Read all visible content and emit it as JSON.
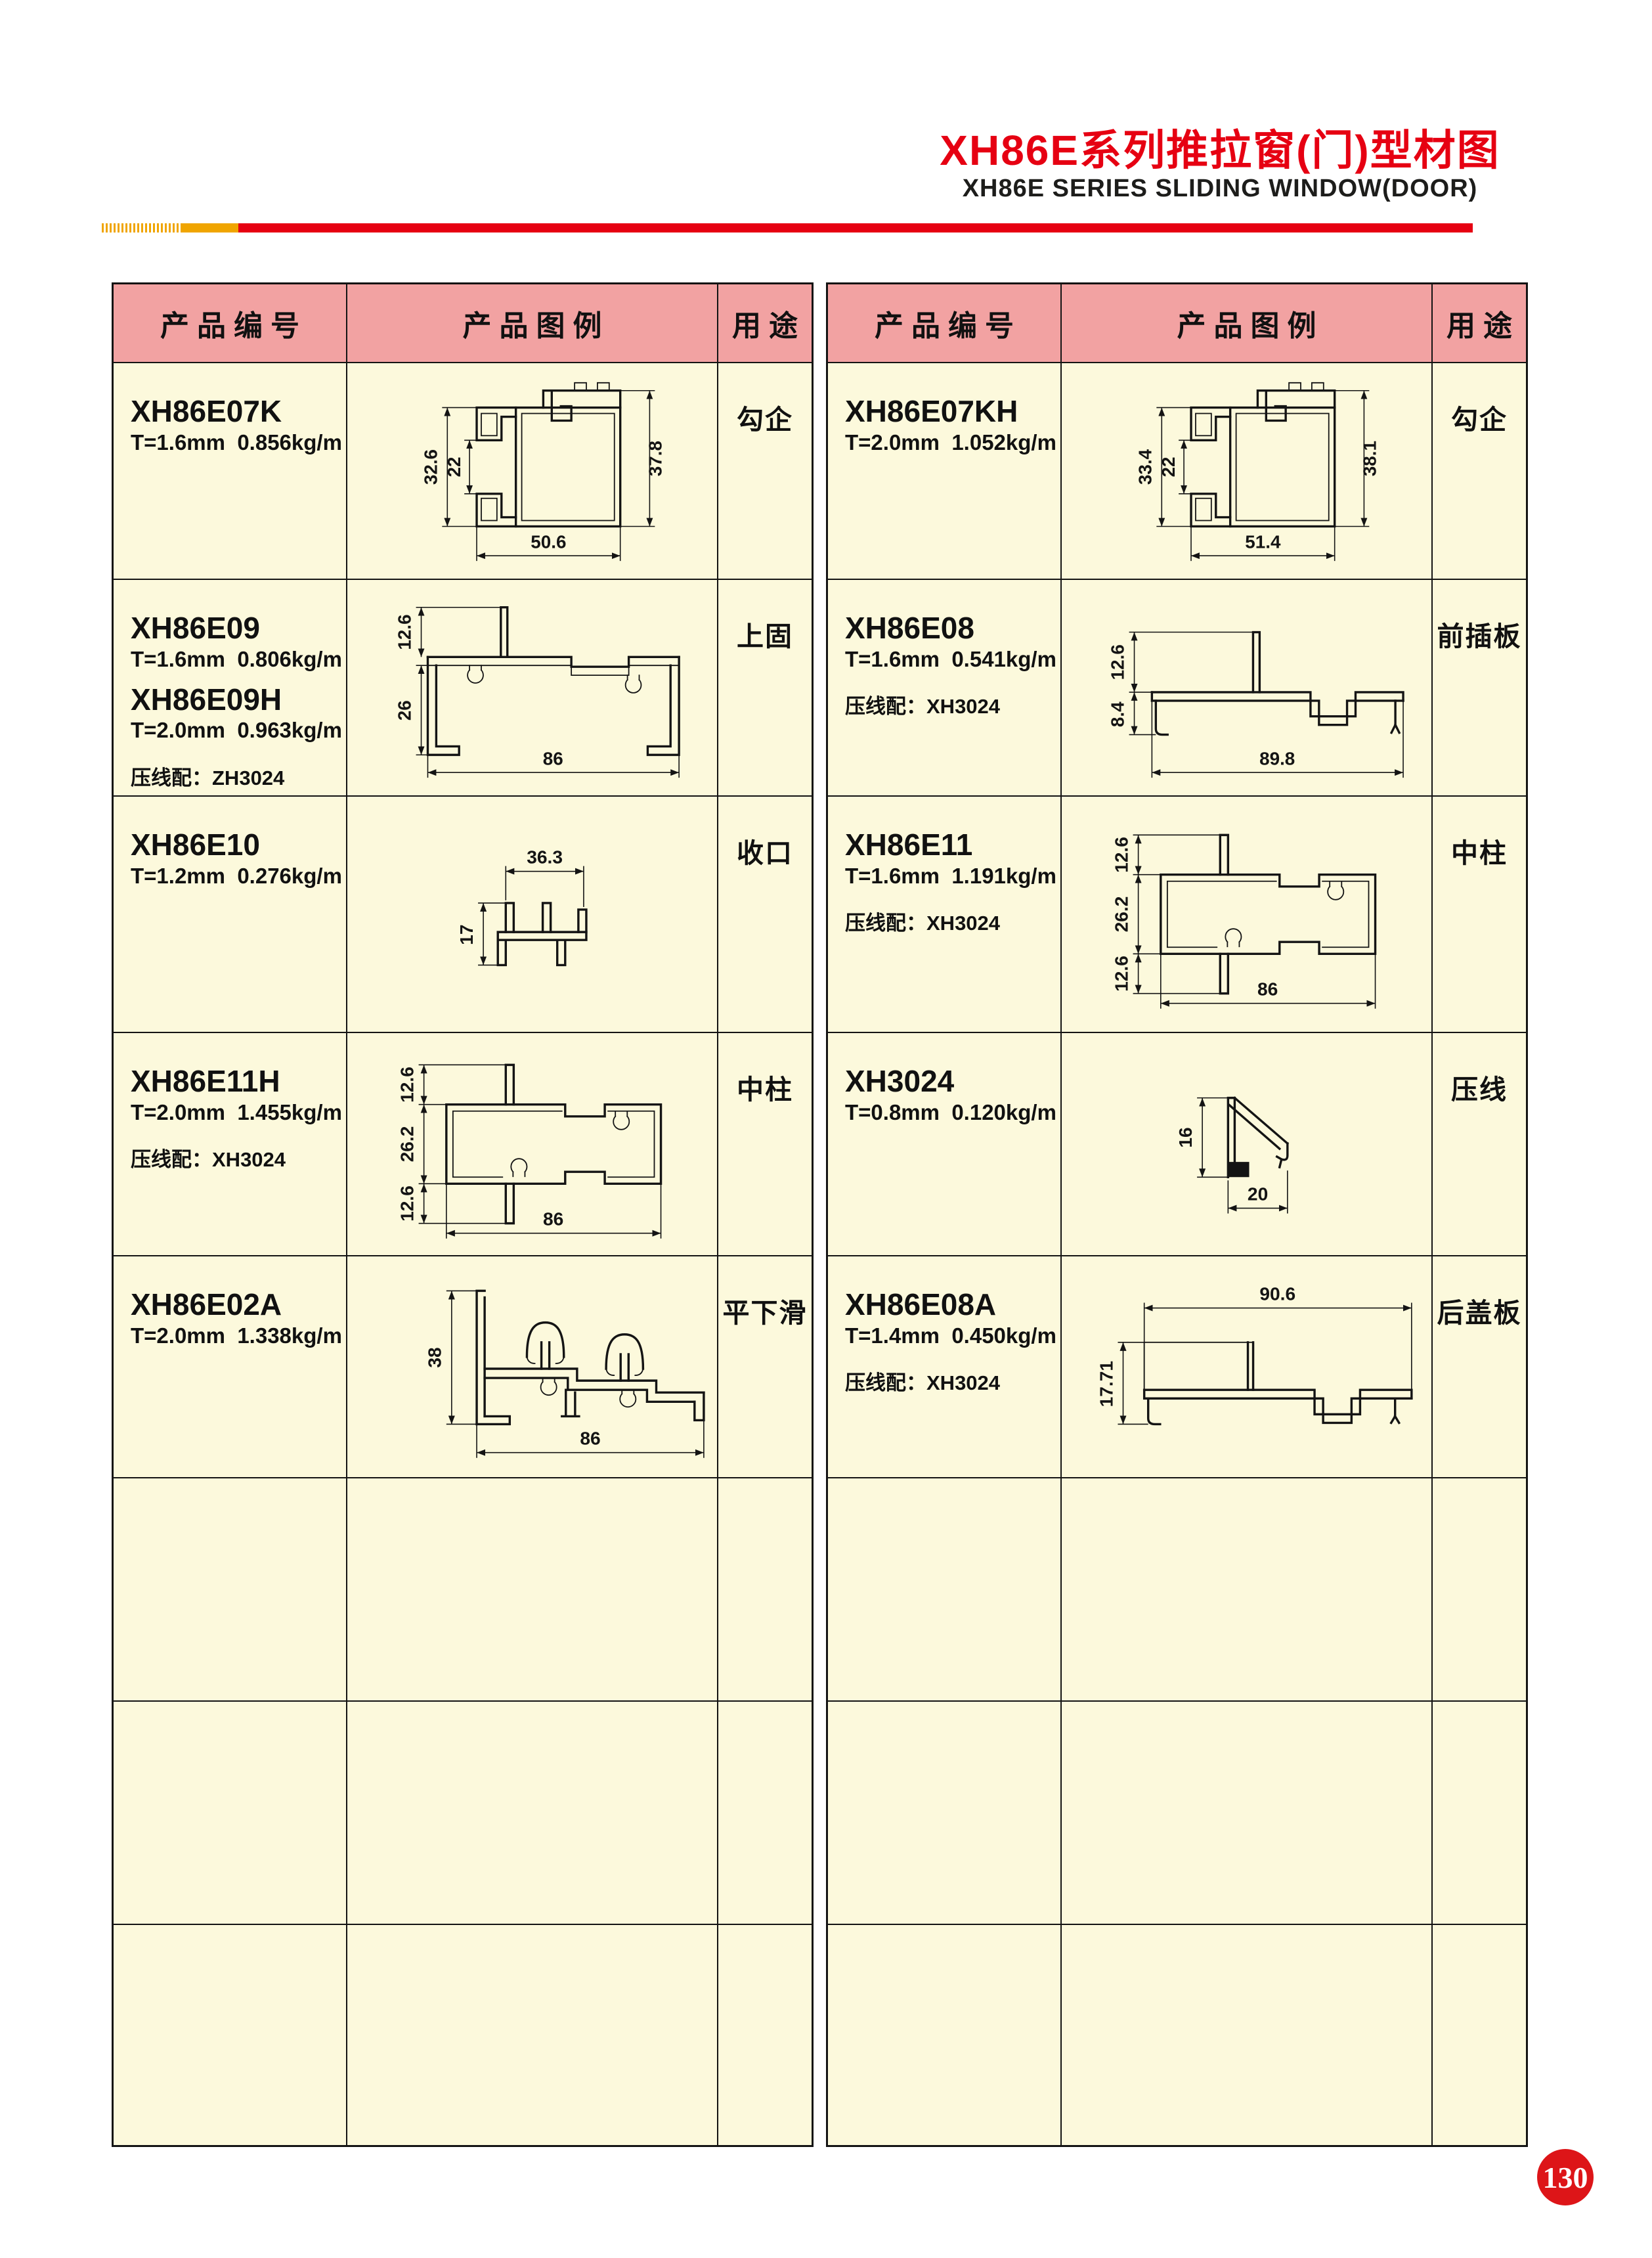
{
  "page": {
    "title_cn": "XH86E系列推拉窗(门)型材图",
    "title_en": "XH86E SERIES SLIDING WINDOW(DOOR)",
    "page_number": "130"
  },
  "colors": {
    "title_red": "#e60012",
    "bar_red": "#e60012",
    "bar_yellow": "#f0a500",
    "header_pink": "#f2a2a2",
    "cell_cream": "#fcf9dc",
    "badge_red": "#dd1518"
  },
  "headers": {
    "code": "产品编号",
    "illustration": "产品图例",
    "usage": "用途"
  },
  "left_table": {
    "rows": [
      {
        "codes": [
          {
            "code": "XH86E07K",
            "spec": "T=1.6mm  0.856kg/m"
          }
        ],
        "usage": "勾企",
        "dims": {
          "left_outer": "32.6",
          "left_inner": "22",
          "right": "37.8",
          "bottom": "50.6"
        }
      },
      {
        "codes": [
          {
            "code": "XH86E09",
            "spec": "T=1.6mm  0.806kg/m"
          },
          {
            "code": "XH86E09H",
            "spec": "T=2.0mm  0.963kg/m"
          }
        ],
        "accessory": "压线配：ZH3024",
        "usage": "上固",
        "dims": {
          "top": "12.6",
          "left": "26",
          "bottom": "86"
        }
      },
      {
        "codes": [
          {
            "code": "XH86E10",
            "spec": "T=1.2mm  0.276kg/m"
          }
        ],
        "usage": "收口",
        "dims": {
          "top": "36.3",
          "left": "17"
        }
      },
      {
        "codes": [
          {
            "code": "XH86E11H",
            "spec": "T=2.0mm  1.455kg/m"
          }
        ],
        "accessory": "压线配：XH3024",
        "usage": "中柱",
        "dims": {
          "top": "12.6",
          "middle": "26.2",
          "bottom_left": "12.6",
          "bottom": "86"
        }
      },
      {
        "codes": [
          {
            "code": "XH86E02A",
            "spec": "T=2.0mm  1.338kg/m"
          }
        ],
        "usage": "平下滑",
        "dims": {
          "left": "38",
          "bottom": "86"
        }
      },
      {},
      {},
      {}
    ]
  },
  "right_table": {
    "rows": [
      {
        "codes": [
          {
            "code": "XH86E07KH",
            "spec": "T=2.0mm  1.052kg/m"
          }
        ],
        "usage": "勾企",
        "dims": {
          "left_outer": "33.4",
          "left_inner": "22",
          "right": "38.1",
          "bottom": "51.4"
        }
      },
      {
        "codes": [
          {
            "code": "XH86E08",
            "spec": "T=1.6mm  0.541kg/m"
          }
        ],
        "accessory": "压线配：XH3024",
        "usage": "前插板",
        "dims": {
          "tab": "12.6",
          "lip": "8.4",
          "bottom": "89.8"
        }
      },
      {
        "codes": [
          {
            "code": "XH86E11",
            "spec": "T=1.6mm  1.191kg/m"
          }
        ],
        "accessory": "压线配：XH3024",
        "usage": "中柱",
        "dims": {
          "top": "12.6",
          "middle": "26.2",
          "bottom_left": "12.6",
          "bottom": "86"
        }
      },
      {
        "codes": [
          {
            "code": "XH3024",
            "spec": "T=0.8mm  0.120kg/m"
          }
        ],
        "usage": "压线",
        "dims": {
          "left": "16",
          "bottom": "20"
        }
      },
      {
        "codes": [
          {
            "code": "XH86E08A",
            "spec": "T=1.4mm  0.450kg/m"
          }
        ],
        "accessory": "压线配：XH3024",
        "usage": "后盖板",
        "dims": {
          "top": "90.6",
          "left": "17.71"
        }
      },
      {},
      {},
      {}
    ]
  }
}
